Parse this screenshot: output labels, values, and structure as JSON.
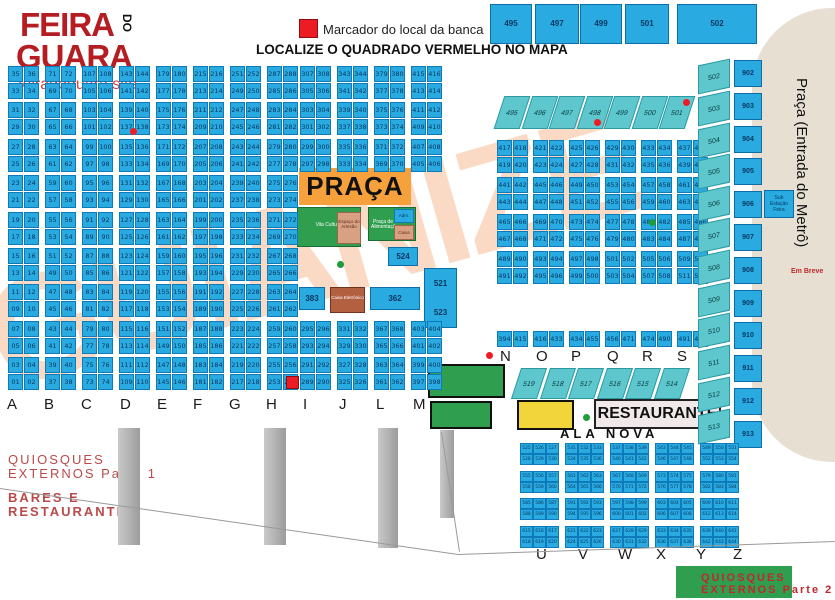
{
  "brand": {
    "name_line1": "FEIRA",
    "name_do": "DO",
    "name_line2": "GUARA",
    "site": "feiradoguara.site"
  },
  "legend": {
    "marker_label": "Marcador do local da banca"
  },
  "headline": "LOCALIZE O QUADRADO VERMELHO NO MAPA",
  "watermark": "GUIANIZE",
  "top_squares": [
    "495",
    "497",
    "499",
    "501",
    "502"
  ],
  "teal_row": [
    "495",
    "496",
    "497",
    "498",
    "499",
    "500",
    "501"
  ],
  "left_columns": [
    {
      "letter": "A",
      "start": 1
    },
    {
      "letter": "B",
      "start": 37
    },
    {
      "letter": "C",
      "start": 73
    },
    {
      "letter": "D",
      "start": 109
    },
    {
      "letter": "E",
      "start": 145
    },
    {
      "letter": "F",
      "start": 181
    },
    {
      "letter": "G",
      "start": 217
    },
    {
      "letter": "H",
      "start": 253
    }
  ],
  "middle_columns": [
    {
      "letter": "I",
      "start": 289
    },
    {
      "letter": "J",
      "start": 325
    },
    {
      "letter": "L",
      "start": 361
    },
    {
      "letter": "M",
      "start": 397
    }
  ],
  "bottom_letters": [
    "A",
    "B",
    "C",
    "D",
    "E",
    "F",
    "G",
    "H",
    "I",
    "J",
    "L",
    "M"
  ],
  "right_grid": {
    "start": 417,
    "letters": [
      "N",
      "O",
      "P",
      "Q",
      "R",
      "S",
      "T"
    ],
    "bottom_pairs": [
      [
        "394",
        "415"
      ],
      [
        "416",
        "433"
      ],
      [
        "434",
        "455"
      ],
      [
        "456",
        "471"
      ],
      [
        "474",
        "490"
      ],
      [
        "491",
        "494"
      ]
    ]
  },
  "diagonal_row": [
    "519",
    "518",
    "517",
    "516",
    "515",
    "514"
  ],
  "side_columns": {
    "teal": [
      "502",
      "503",
      "504",
      "505",
      "506",
      "507",
      "508",
      "509",
      "510",
      "511",
      "512",
      "513"
    ],
    "blue": [
      "902",
      "903",
      "904",
      "905",
      "906",
      "907",
      "908",
      "909",
      "910",
      "911",
      "912",
      "913"
    ],
    "substation": "Sub Estação Feira"
  },
  "metro": {
    "label": "Praça (Entrada do Metrô)",
    "em_breve": "Em Breve"
  },
  "praca": {
    "title": "PRAÇA",
    "vila": "Vila Cultural",
    "artesao": "Espaço do Artesão",
    "alimentacao": "Praça de Alimentação",
    "adm": "Adm.",
    "caixa_chip": "Caixa",
    "stall_383": "383",
    "caixa_eletronico": "Caixa Eletrônico",
    "stall_362": "362",
    "stall_521": "521",
    "stall_523": "523",
    "stall_524": "524"
  },
  "restaurante": "RESTAURANTE",
  "ala_nova": {
    "label": "ALA NOVA",
    "start": 525,
    "letters": [
      "U",
      "V",
      "W",
      "X",
      "Y",
      "Z"
    ]
  },
  "quiosques1_line1": "QUIOSQUES",
  "quiosques1_line2": "EXTERNOS Parte 1",
  "bares_line1": "BARES E",
  "bares_line2": "RESTAURANTES",
  "quiosques2_line1": "QUIOSQUES",
  "quiosques2_line2": "EXTERNOS Parte 2",
  "colors": {
    "stall_blue": "#29abe2",
    "teal": "#5ec7cd",
    "orange": "#f7a13c",
    "green": "#2f9e4f",
    "yellow": "#f2d53b",
    "red": "#ed1c24",
    "brand_red": "#b51d22",
    "beige": "#e7dfd2"
  }
}
